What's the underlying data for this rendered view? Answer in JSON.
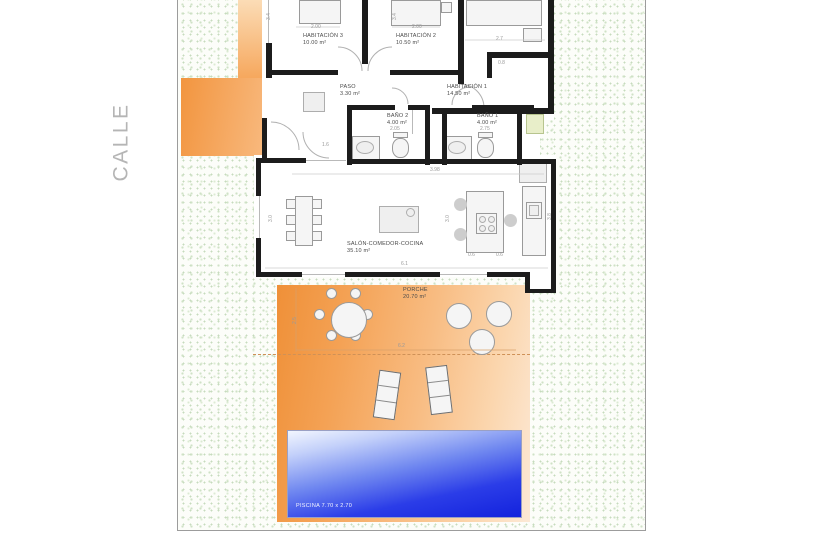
{
  "street": {
    "label": "CALLE"
  },
  "rooms": {
    "habitacion3": {
      "name": "HABITACIÓN 3",
      "area": "10.00 m²"
    },
    "habitacion2": {
      "name": "HABITACIÓN 2",
      "area": "10.50 m²"
    },
    "habitacion1": {
      "name": "HABITACIÓN 1",
      "area": "14.50 m²"
    },
    "paso": {
      "name": "PASO",
      "area": "3.30 m²"
    },
    "bano2": {
      "name": "BAÑO 2",
      "area": "4.00 m²"
    },
    "bano1": {
      "name": "BAÑO 1",
      "area": "4.00 m²"
    },
    "salon": {
      "name": "SALÓN-COMEDOR-COCINA",
      "area": "35.10 m²"
    },
    "porche": {
      "name": "PORCHE",
      "area": "20.70 m²"
    }
  },
  "pool": {
    "label": "PISCINA 7.70 x 2.70"
  },
  "dimensions": [
    {
      "t": "2.00",
      "x": 311,
      "y": 24
    },
    {
      "t": "2.00",
      "x": 412,
      "y": 24
    },
    {
      "t": "2.7",
      "x": 496,
      "y": 36
    },
    {
      "t": "3.4",
      "x": 266,
      "y": 20,
      "v": true
    },
    {
      "t": "3.4",
      "x": 392,
      "y": 20,
      "v": true
    },
    {
      "t": "0.8",
      "x": 498,
      "y": 60
    },
    {
      "t": "1.6",
      "x": 322,
      "y": 142
    },
    {
      "t": "2.05",
      "x": 390,
      "y": 126
    },
    {
      "t": "2.75",
      "x": 480,
      "y": 126
    },
    {
      "t": "3.98",
      "x": 430,
      "y": 167
    },
    {
      "t": "3.0",
      "x": 268,
      "y": 222,
      "v": true
    },
    {
      "t": "3.0",
      "x": 445,
      "y": 222,
      "v": true
    },
    {
      "t": "3.8",
      "x": 547,
      "y": 220,
      "v": true
    },
    {
      "t": "0.6",
      "x": 468,
      "y": 252
    },
    {
      "t": "0.6",
      "x": 496,
      "y": 252
    },
    {
      "t": "6.1",
      "x": 401,
      "y": 261
    },
    {
      "t": "2.5",
      "x": 292,
      "y": 324,
      "v": true
    },
    {
      "t": "6.2",
      "x": 398,
      "y": 343
    }
  ],
  "colors": {
    "wall": "#1c1c1c",
    "label": "#4a4a4a",
    "street_text": "#b5b5b5",
    "garden_dot": "#cfe2c6",
    "drive_orange": "#f2953f",
    "deck_orange_strong": "#ef9038",
    "deck_orange_light": "#fce9d6",
    "pool_deep": "#1322dd",
    "pool_light": "#f2f6ff"
  }
}
